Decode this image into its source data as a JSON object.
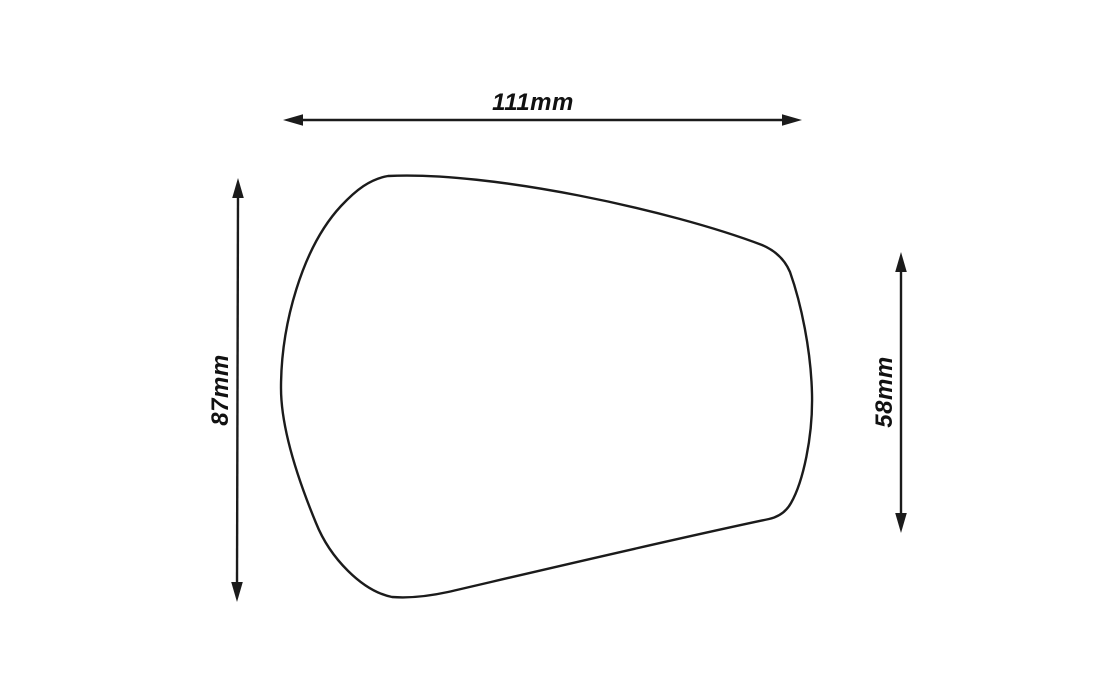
{
  "diagram": {
    "subject": "mirror-glass-outline",
    "background_color": "#ffffff",
    "line_color": "#1b1b1b",
    "dimensions": {
      "width": {
        "label": "111mm",
        "value_mm": 111,
        "orientation": "horizontal",
        "position": "top"
      },
      "height_left": {
        "label": "87mm",
        "value_mm": 87,
        "orientation": "vertical",
        "position": "left"
      },
      "height_right": {
        "label": "58mm",
        "value_mm": 58,
        "orientation": "vertical",
        "position": "right"
      }
    }
  }
}
